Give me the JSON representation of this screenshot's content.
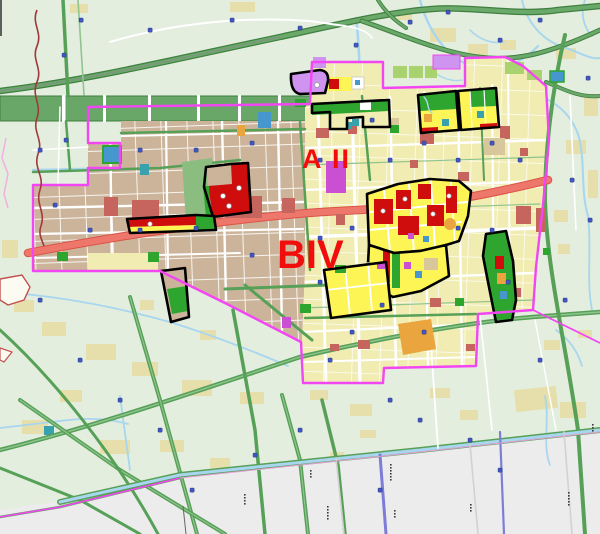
{
  "map": {
    "labels": [
      {
        "id": "district_a",
        "text": "A II"
      },
      {
        "id": "district_b",
        "text": "BIV"
      }
    ]
  },
  "colors": {
    "rural_bg": "#e3eedf",
    "outside_bg": "#ececec",
    "village_tan": "#e7dfab",
    "urban_tan": "#ccb49b",
    "pale_yellow": "#f0ecb2",
    "bright_yellow": "#fdf456",
    "red_bright": "#d00d0d",
    "red_muted": "#c5655e",
    "park_green": "#2ea52e",
    "park_light": "#8cbd80",
    "leaf_green": "#a9d36e",
    "belt_green": "#68a768",
    "highway_green": "#6aa96a",
    "highway_dark": "#3f7f3f",
    "road_green": "#57a057",
    "road_green_light": "#8fc48f",
    "road_white": "#ffffff",
    "road_gray": "#d2d2d2",
    "road_indigo": "#7d7dd8",
    "water_blue": "#a8d6ee",
    "marker_blue": "#4156c0",
    "blue_block": "#4597cd",
    "teal_block": "#37a2ae",
    "orange_block": "#eaa53e",
    "beige_block": "#d9c79c",
    "violet_block": "#cf93f0",
    "magenta_block": "#cb4fd2",
    "boundary_magenta": "#f346f3",
    "arterial_red": "#ee776b",
    "arterial_edge": "#da5347",
    "county_line": "#a03a3a",
    "outline_black": "#000000",
    "label_red": "#f20d0d"
  }
}
